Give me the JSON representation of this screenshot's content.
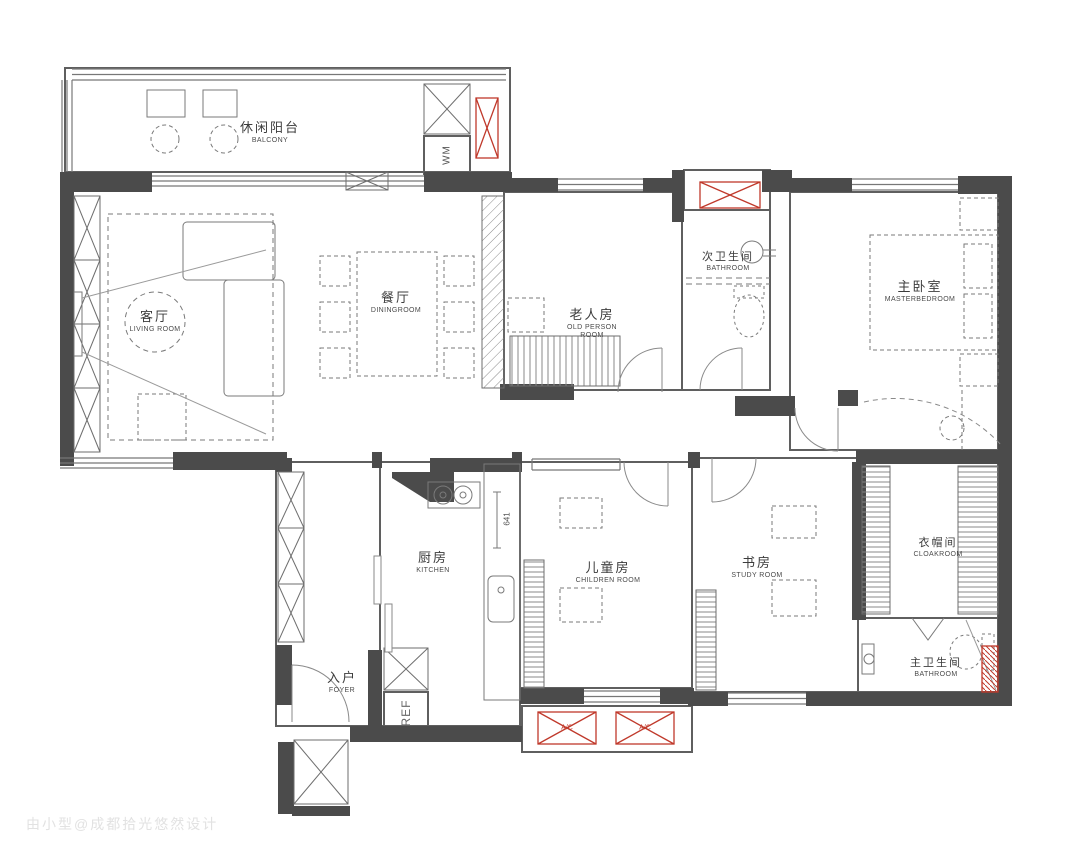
{
  "watermark": "由小型@成都拾光悠然设计",
  "colors": {
    "wall": "#4b4b4b",
    "line": "#6b6b6b",
    "accent_red": "#c0392b"
  },
  "rooms": {
    "balcony": {
      "zh": "休闲阳台",
      "en": "BALCONY"
    },
    "living": {
      "zh": "客厅",
      "en": "LIVING ROOM"
    },
    "dining": {
      "zh": "餐厅",
      "en": "DININGROOM"
    },
    "old_person": {
      "zh": "老人房",
      "en": "OLD PERSON ROOM"
    },
    "second_bath": {
      "zh": "次卫生间",
      "en": "BATHROOM"
    },
    "master_bedroom": {
      "zh": "主卧室",
      "en": "MASTERBEDROOM"
    },
    "kitchen": {
      "zh": "厨房",
      "en": "KITCHEN"
    },
    "children": {
      "zh": "儿童房",
      "en": "CHILDREN ROOM"
    },
    "study": {
      "zh": "书房",
      "en": "STUDY ROOM"
    },
    "cloakroom": {
      "zh": "衣帽间",
      "en": "CLOAKROOM"
    },
    "master_bath": {
      "zh": "主卫生间",
      "en": "BATHROOM"
    },
    "foyer": {
      "zh": "入户",
      "en": "FOYER"
    }
  },
  "appliances": {
    "washing_machine": "WM",
    "refrigerator": "REF",
    "ac_1": "A/C",
    "ac_2": "A/C"
  },
  "dimensions": {
    "kitchen_counter": "641"
  }
}
